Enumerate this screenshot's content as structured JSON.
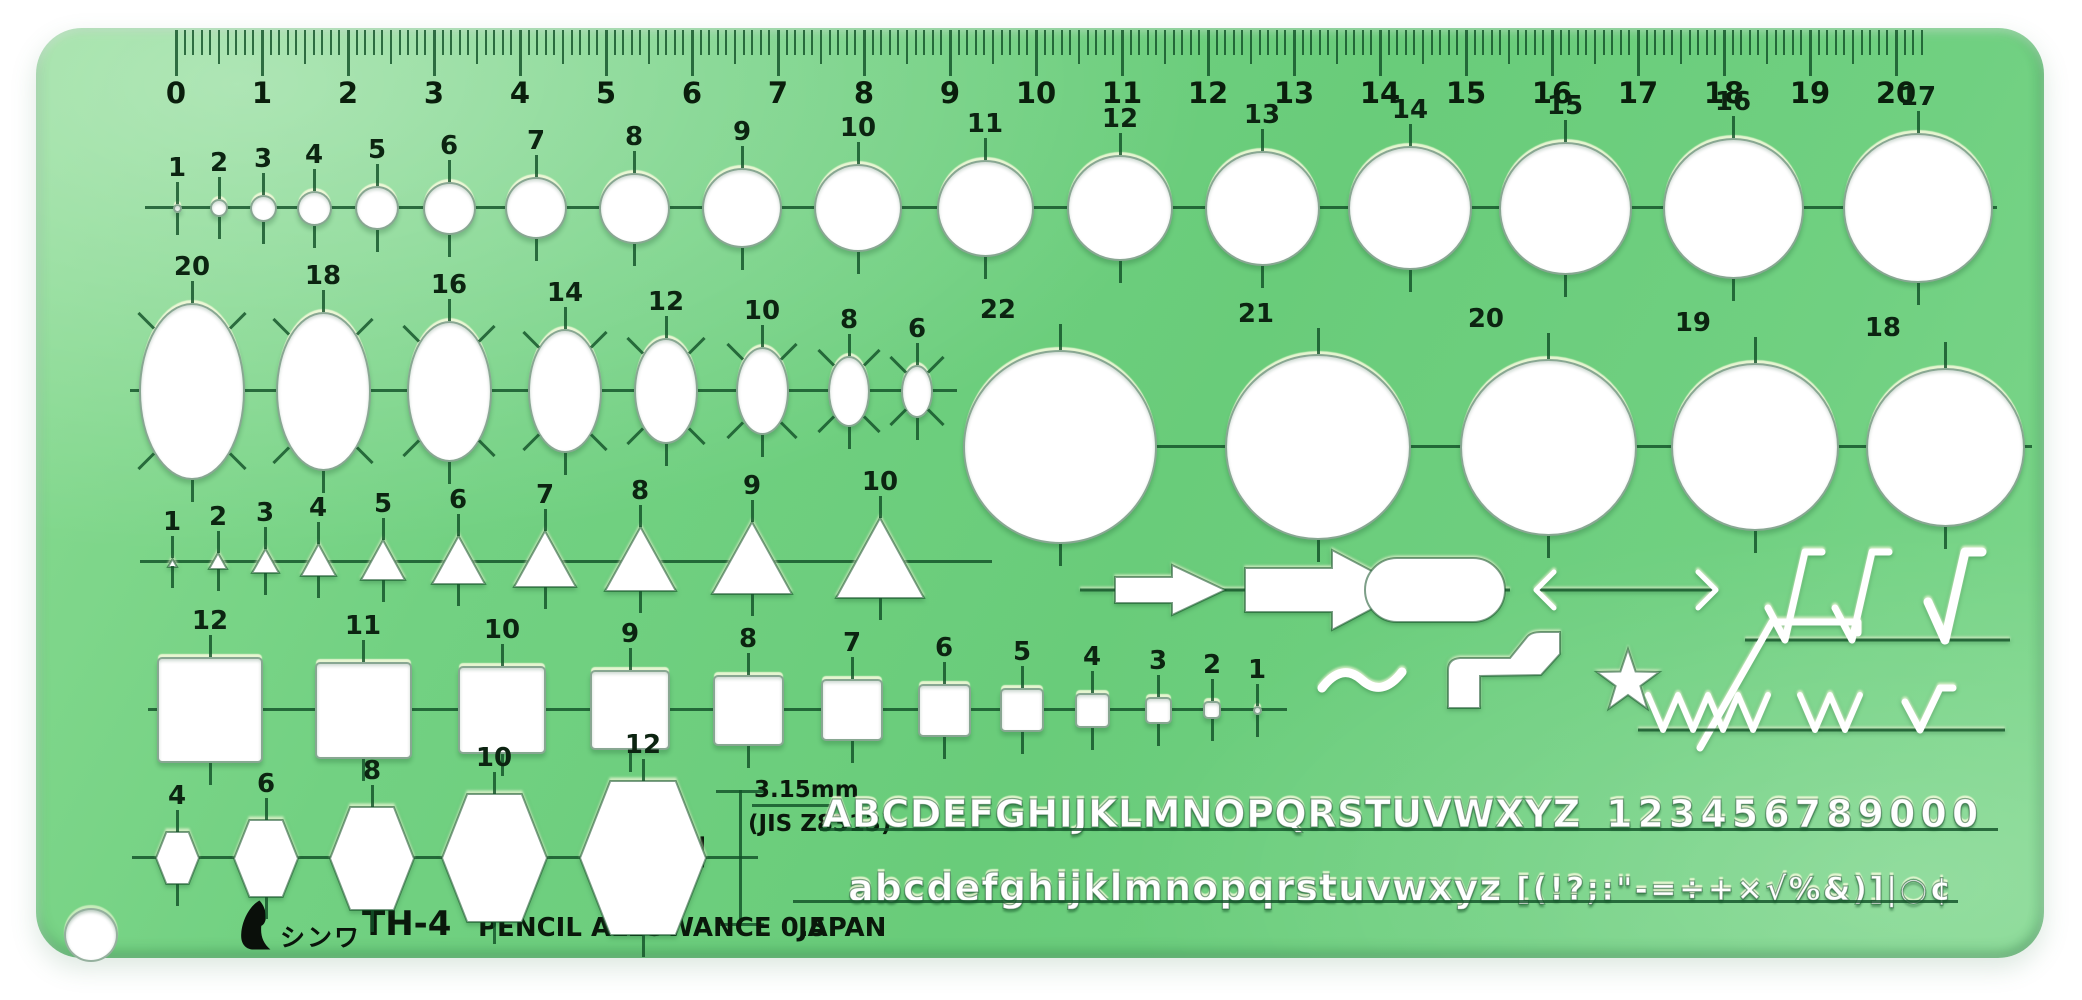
{
  "product": {
    "brand": "シンワ",
    "model": "TH-4",
    "allowance": "PENCIL ALLOWANCE 0.5",
    "country": "JAPAN"
  },
  "note": {
    "size": "12",
    "height": "3.15mm",
    "standard": "(JIS Z8313)"
  },
  "ruler": {
    "unit": "cm",
    "labels": [
      "0",
      "1",
      "2",
      "3",
      "4",
      "5",
      "6",
      "7",
      "8",
      "9",
      "10",
      "11",
      "12",
      "13",
      "14",
      "15",
      "16",
      "17",
      "18",
      "19",
      "20"
    ]
  },
  "shape_rows": {
    "circles": {
      "labels": [
        "1",
        "2",
        "3",
        "4",
        "5",
        "6",
        "7",
        "8",
        "9",
        "10",
        "11",
        "12",
        "13",
        "14",
        "15",
        "16",
        "17"
      ]
    },
    "ellipses": {
      "labels": [
        "20",
        "18",
        "16",
        "14",
        "12",
        "10",
        "8",
        "6"
      ]
    },
    "large_circles": {
      "labels": [
        "22",
        "21",
        "20",
        "19",
        "18"
      ]
    },
    "triangles": {
      "labels": [
        "1",
        "2",
        "3",
        "4",
        "5",
        "6",
        "7",
        "8",
        "9",
        "10"
      ]
    },
    "squares": {
      "labels": [
        "12",
        "11",
        "10",
        "9",
        "8",
        "7",
        "6",
        "5",
        "4",
        "3",
        "2",
        "1"
      ]
    },
    "hexagons": {
      "labels": [
        "4",
        "6",
        "8",
        "10",
        "12"
      ]
    }
  },
  "lettering": {
    "uppercase": "ABCDEFGHIJKLMNOPQRSTUVWXYZ",
    "numerals": "123456789000",
    "lowercase": "abcdefghijklmnopqrstuvwxyz",
    "symbols": "[(!?;:\"-=÷+×√%&)]|○¢"
  },
  "drafting_symbols": [
    "flow-arrow-small",
    "flow-arrow-large",
    "capsule-terminator",
    "double-headed-arrow",
    "surface-finish-checks",
    "tilde-wave",
    "pointer-flag",
    "star",
    "surface-roughness-radical",
    "zigzag-finish-marks"
  ],
  "colors": {
    "body_green": "#6fd080",
    "engraved_line": "#125228",
    "label_ink": "#0c2411",
    "cutout": "#ffffff",
    "print_ink": "#0a180b"
  }
}
